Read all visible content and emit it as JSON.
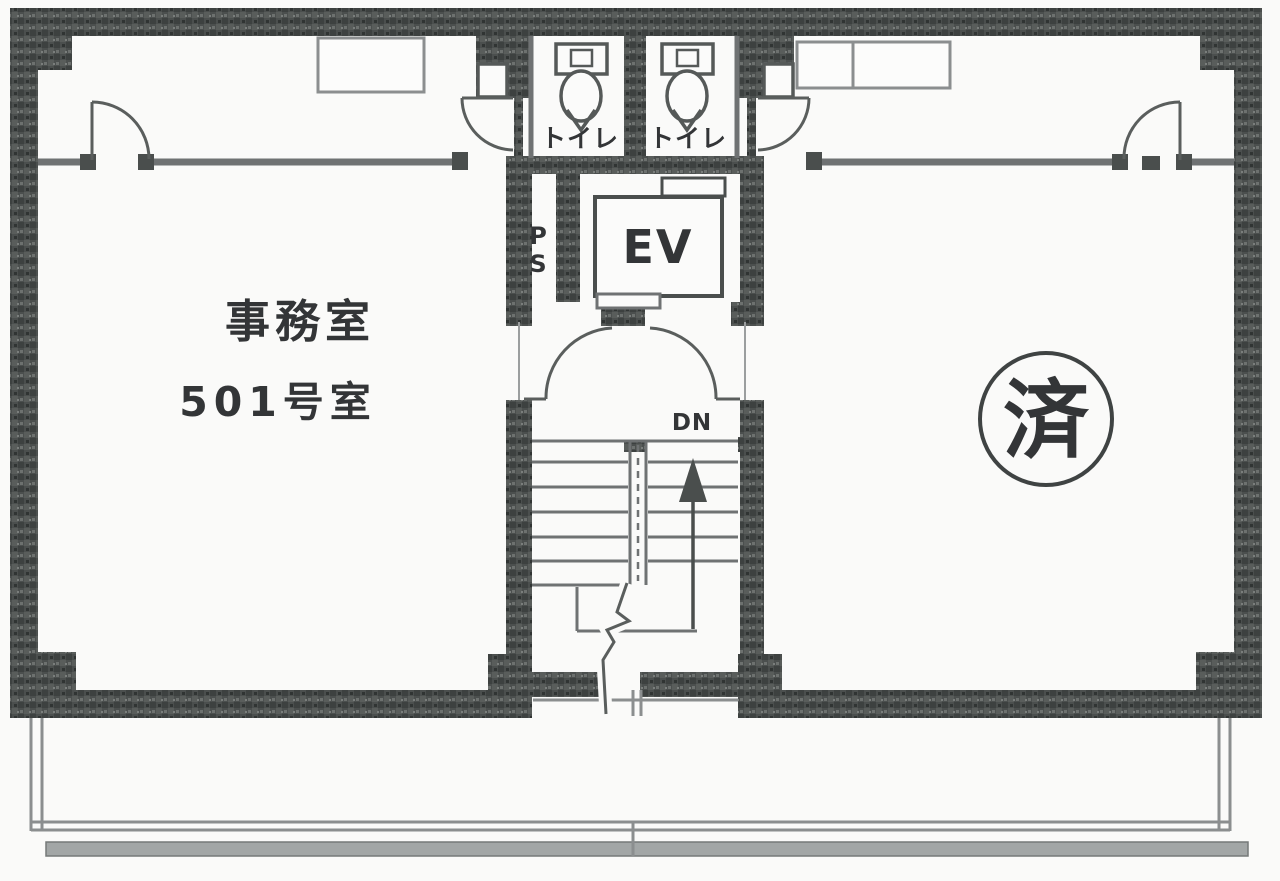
{
  "plan": {
    "left_room": {
      "name": "事務室",
      "number": "501号室"
    },
    "right_room": {
      "seal": "済"
    },
    "core": {
      "toilets": [
        {
          "label": "トイレ"
        },
        {
          "label": "トイレ"
        }
      ],
      "pipe_space": {
        "letters": [
          "P",
          "S"
        ]
      },
      "elevator": {
        "label": "EV"
      },
      "hall": {
        "down_label": "DN"
      }
    }
  },
  "icons": {
    "up_arrow": "filled-triangle-with-shaft (stairs up)",
    "door_swing": "quarter-circle-arc",
    "toilet_fixture": "tank-rect + bowl-ellipse",
    "seal": "kanji-in-circle",
    "break_line": "zigzag-cut"
  },
  "colors": {
    "paper": "#fafaf9",
    "wall": "#4a4e4d",
    "thin_wall": "#6f7273",
    "furniture_line": "#8b8e8f",
    "ink": "#333537"
  }
}
